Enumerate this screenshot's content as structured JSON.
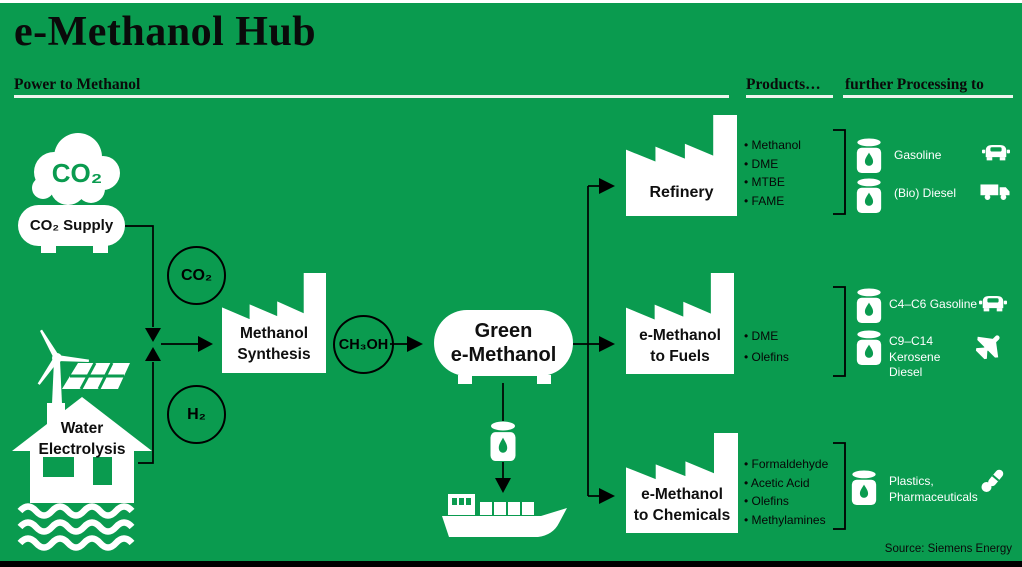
{
  "header": {
    "title": "e-Methanol Hub",
    "col_power": "Power to Methanol",
    "col_products": "Products…",
    "col_processing": "further Processing to"
  },
  "inputs": {
    "co2_cloud": "CO₂",
    "co2_supply": "CO₂ Supply",
    "water_electrolysis": "Water\nElectrolysis"
  },
  "process": {
    "co2_feed": "CO₂",
    "h2_feed": "H₂",
    "methanol_synthesis": "Methanol\nSynthesis",
    "ch3oh": "CH₃OH",
    "green_emethanol": "Green\ne-Methanol"
  },
  "routes": [
    {
      "plant": "Refinery",
      "products": [
        "Methanol",
        "DME",
        "MTBE",
        "FAME"
      ],
      "outputs": [
        {
          "label": "Gasoline",
          "vehicle": "car-icon"
        },
        {
          "label": "(Bio) Diesel",
          "vehicle": "truck-icon"
        }
      ]
    },
    {
      "plant": "e-Methanol\nto Fuels",
      "products": [
        "DME",
        "Olefins"
      ],
      "outputs": [
        {
          "label": "C4–C6 Gasoline",
          "vehicle": "car-icon"
        },
        {
          "label": "C9–C14\nKerosene\nDiesel",
          "vehicle": "plane-icon"
        }
      ]
    },
    {
      "plant": "e-Methanol\nto Chemicals",
      "products": [
        "Formaldehyde",
        "Acetic Acid",
        "Olefins",
        "Methylamines"
      ],
      "outputs": [
        {
          "label": "Plastics,\nPharmaceuticals",
          "vehicle": "pills-icon"
        }
      ]
    }
  ],
  "footer": {
    "source": "Source: Siemens Energy"
  },
  "colors": {
    "background": "#0a9b4f",
    "ink": "#000000",
    "white": "#ffffff"
  }
}
